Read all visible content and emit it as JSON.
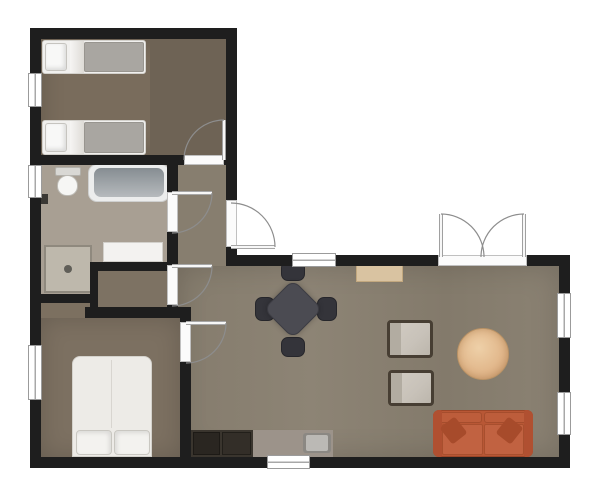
{
  "scene": {
    "width": 604,
    "height": 499,
    "background": "#ffffff",
    "palette": {
      "wall": "#1e1e1e",
      "wood_living": "#8a8172",
      "wood_bedroom": "#796c5c",
      "tile_bathroom": "#a89f93",
      "sofa_orange": "#b85735",
      "rug_tan": "#e2b88c",
      "table_dark": "#4b4b52",
      "counter_dark": "#3a352e",
      "counter_light": "#9c938a",
      "door_arc": "#8d8d8d"
    },
    "nodes": [
      {
        "name": "living-room-floor",
        "cls": "wood",
        "x": 178,
        "y": 266,
        "w": 381,
        "h": 191,
        "bg": "linear-gradient(90deg,#857c6d 0%,#8d8475 35%,#837a6b 70%,#8b8273 100%)",
        "sh": "inset 0 0 30px rgba(0,0,0,.16)"
      },
      {
        "name": "hallway-floor",
        "cls": "wood",
        "x": 178,
        "y": 165,
        "w": 48,
        "h": 101,
        "bg": "#877e6f"
      },
      {
        "name": "bedroom1-floor",
        "cls": "wood",
        "x": 41,
        "y": 39,
        "w": 185,
        "h": 116,
        "bg": "#796c5c",
        "sh": "inset 0 0 24px rgba(0,0,0,.18)"
      },
      {
        "name": "bedroom1-floor-right",
        "cls": "wood",
        "x": 150,
        "y": 39,
        "w": 76,
        "h": 116,
        "bg": "#6e6355"
      },
      {
        "name": "bathroom-floor",
        "cls": "tile",
        "x": 41,
        "y": 165,
        "w": 126,
        "h": 101,
        "bg": "#a89f93"
      },
      {
        "name": "bathroom-floor-notch",
        "cls": "tile",
        "x": 41,
        "y": 266,
        "w": 57,
        "h": 28,
        "bg": "#a89f93"
      },
      {
        "name": "closet-floor",
        "cls": "wood",
        "x": 98,
        "y": 271,
        "w": 69,
        "h": 36,
        "bg": "#7d7263"
      },
      {
        "name": "bedroom2-floor-strip",
        "cls": "wood",
        "x": 41,
        "y": 303,
        "w": 49,
        "h": 15,
        "bg": "#7c7060"
      },
      {
        "name": "bedroom2-floor",
        "cls": "wood",
        "x": 41,
        "y": 318,
        "w": 139,
        "h": 139,
        "bg": "#7c7061",
        "sh": "inset 0 0 24px rgba(0,0,0,.16)"
      },
      {
        "name": "single-bed-1-frame",
        "x": 42,
        "y": 40,
        "w": 104,
        "h": 34,
        "bg": "#f1f0ee",
        "bd": "1px solid #d3d1cc",
        "r": "3px"
      },
      {
        "name": "single-bed-1-fold",
        "x": 70,
        "y": 41,
        "w": 14,
        "h": 32,
        "bg": "linear-gradient(90deg,#f6f5f3,#dedbd6)"
      },
      {
        "name": "single-bed-1-duvet",
        "x": 84,
        "y": 42,
        "w": 60,
        "h": 30,
        "bg": "#a9a6a1",
        "bd": "1px solid #98958f",
        "r": "2px"
      },
      {
        "name": "single-bed-1-pillow",
        "x": 45,
        "y": 43,
        "w": 22,
        "h": 28,
        "bg": "#f8f8f7",
        "bd": "1px solid #c6c4bf",
        "r": "3px",
        "sh": "inset -2px -2px 4px rgba(0,0,0,.12)"
      },
      {
        "name": "single-bed-2-frame",
        "x": 42,
        "y": 120,
        "w": 104,
        "h": 35,
        "bg": "#f1f0ee",
        "bd": "1px solid #d3d1cc",
        "r": "3px"
      },
      {
        "name": "single-bed-2-fold",
        "x": 70,
        "y": 121,
        "w": 14,
        "h": 33,
        "bg": "linear-gradient(90deg,#f6f5f3,#dedbd6)"
      },
      {
        "name": "single-bed-2-duvet",
        "x": 84,
        "y": 122,
        "w": 60,
        "h": 31,
        "bg": "#a9a6a1",
        "bd": "1px solid #98958f",
        "r": "2px"
      },
      {
        "name": "single-bed-2-pillow",
        "x": 45,
        "y": 123,
        "w": 22,
        "h": 29,
        "bg": "#f8f8f7",
        "bd": "1px solid #c6c4bf",
        "r": "3px",
        "sh": "inset -2px -2px 4px rgba(0,0,0,.12)"
      },
      {
        "name": "toilet-tank",
        "x": 55,
        "y": 167,
        "w": 26,
        "h": 9,
        "bg": "#d9d8d4",
        "bd": "1px solid #b3b1ab",
        "r": "2px"
      },
      {
        "name": "toilet-bowl",
        "x": 57,
        "y": 175,
        "w": 21,
        "h": 21,
        "bg": "#f6f6f4",
        "bd": "1px solid #bdbbb5",
        "r": "50% 50% 46% 46%"
      },
      {
        "name": "bathtub",
        "x": 88,
        "y": 164,
        "w": 82,
        "h": 38,
        "bg": "#eceded",
        "bd": "1px solid #cfd0d0",
        "r": "9px"
      },
      {
        "name": "bathtub-basin",
        "x": 94,
        "y": 168,
        "w": 70,
        "h": 29,
        "bg": "linear-gradient(180deg,#868d92,#b6babd)",
        "r": "7px"
      },
      {
        "name": "towel-radiator",
        "x": 41,
        "y": 194,
        "w": 7,
        "h": 10,
        "bg": "#3a3834"
      },
      {
        "name": "shower",
        "x": 44,
        "y": 245,
        "w": 48,
        "h": 48,
        "bg": "#beb8ac",
        "bd": "2px solid #8f897e"
      },
      {
        "name": "shower-drain",
        "x": 64,
        "y": 265,
        "w": 8,
        "h": 8,
        "bg": "#605e58",
        "r": "50%"
      },
      {
        "name": "bathroom-vanity",
        "x": 103,
        "y": 242,
        "w": 60,
        "h": 20,
        "bg": "#f3f2f0",
        "bd": "1px solid #d2d0cb"
      },
      {
        "name": "double-bed-frame",
        "x": 72,
        "y": 356,
        "w": 80,
        "h": 101,
        "bg": "#edebe7",
        "bd": "1px solid #d4d2cc",
        "r": "8px 8px 0 0"
      },
      {
        "name": "double-bed-crease",
        "x": 111,
        "y": 360,
        "w": 1,
        "h": 68,
        "bg": "#d8d5d0"
      },
      {
        "name": "double-bed-pillow-left",
        "x": 76,
        "y": 430,
        "w": 36,
        "h": 25,
        "bg": "#f3f2ef",
        "bd": "1px solid #c9c7c1",
        "r": "4px",
        "sh": "inset -2px 2px 4px rgba(0,0,0,.10)"
      },
      {
        "name": "double-bed-pillow-right",
        "x": 114,
        "y": 430,
        "w": 36,
        "h": 25,
        "bg": "#f3f2ef",
        "bd": "1px solid #c9c7c1",
        "r": "4px",
        "sh": "inset 2px 2px 4px rgba(0,0,0,.10)"
      },
      {
        "name": "dining-chair-north",
        "x": 281,
        "y": 261,
        "w": 24,
        "h": 20,
        "bg": "#34343a",
        "bd": "1px solid #26262b",
        "r": "7px"
      },
      {
        "name": "dining-chair-south",
        "x": 281,
        "y": 337,
        "w": 24,
        "h": 20,
        "bg": "#34343a",
        "bd": "1px solid #26262b",
        "r": "7px"
      },
      {
        "name": "dining-chair-west",
        "x": 255,
        "y": 297,
        "w": 20,
        "h": 24,
        "bg": "#34343a",
        "bd": "1px solid #26262b",
        "r": "7px"
      },
      {
        "name": "dining-chair-east",
        "x": 317,
        "y": 297,
        "w": 20,
        "h": 24,
        "bg": "#34343a",
        "bd": "1px solid #26262b",
        "r": "7px"
      },
      {
        "name": "dining-table",
        "x": 272,
        "y": 288,
        "w": 42,
        "h": 42,
        "bg": "#4b4b52",
        "bd": "1px solid #3c3c43",
        "r": "9px",
        "rot": 45,
        "sh": "0 0 6px rgba(0,0,0,.25)"
      },
      {
        "name": "console-mat",
        "x": 356,
        "y": 262,
        "w": 47,
        "h": 20,
        "bg": "#d9c3a1",
        "bd": "1px solid #c2a87f"
      },
      {
        "name": "armchair-1",
        "x": 387,
        "y": 320,
        "w": 46,
        "h": 38,
        "bg": "linear-gradient(135deg,#d2ccc3 0%,#c8c2b9 60%,#bcb6ac 100%)",
        "bd": "3px solid #473e33",
        "r": "4px"
      },
      {
        "name": "armchair-1-throw",
        "x": 390,
        "y": 323,
        "w": 11,
        "h": 32,
        "bg": "#b2aca1"
      },
      {
        "name": "armchair-2",
        "x": 388,
        "y": 370,
        "w": 46,
        "h": 36,
        "bg": "linear-gradient(135deg,#d2ccc3 0%,#c8c2b9 60%,#bcb6ac 100%)",
        "bd": "3px solid #473e33",
        "r": "4px"
      },
      {
        "name": "armchair-2-throw",
        "x": 391,
        "y": 373,
        "w": 11,
        "h": 30,
        "bg": "#b2aca1"
      },
      {
        "name": "round-rug",
        "x": 457,
        "y": 328,
        "w": 52,
        "h": 52,
        "bg": "radial-gradient(circle at 42% 38%, #eed0a8 0%, #e2b88c 55%, #d3a478 85%, #c69868 100%)",
        "bd": "1px solid #b99265",
        "r": "50%",
        "sh": "inset 0 0 8px rgba(140,95,45,.35)"
      },
      {
        "name": "sofa",
        "x": 433,
        "y": 410,
        "w": 100,
        "h": 47,
        "bg": "#b85735",
        "bd": "1px solid #9a4628",
        "r": "6px"
      },
      {
        "name": "sofa-back-left",
        "x": 437,
        "y": 412,
        "w": 45,
        "h": 11,
        "bg": "#bd5d3b",
        "bd": "1px solid #a54d2d",
        "r": "3px"
      },
      {
        "name": "sofa-back-right",
        "x": 484,
        "y": 412,
        "w": 45,
        "h": 11,
        "bg": "#bd5d3b",
        "bd": "1px solid #a54d2d",
        "r": "3px"
      },
      {
        "name": "sofa-armrest-left",
        "x": 433,
        "y": 410,
        "w": 9,
        "h": 47,
        "bg": "#b05031",
        "r": "6px 2px 2px 6px"
      },
      {
        "name": "sofa-armrest-right",
        "x": 524,
        "y": 410,
        "w": 9,
        "h": 47,
        "bg": "#b05031",
        "r": "2px 6px 6px 2px"
      },
      {
        "name": "sofa-seat-left",
        "x": 442,
        "y": 424,
        "w": 41,
        "h": 31,
        "bg": "#c16241",
        "bd": "1px solid #a84f2e",
        "r": "2px"
      },
      {
        "name": "sofa-seat-right",
        "x": 484,
        "y": 424,
        "w": 40,
        "h": 31,
        "bg": "#c16241",
        "bd": "1px solid #a84f2e",
        "r": "2px"
      },
      {
        "name": "sofa-pillow-left",
        "x": 444,
        "y": 420,
        "w": 19,
        "h": 21,
        "bg": "#a74b2b",
        "r": "3px",
        "rot": -38
      },
      {
        "name": "sofa-pillow-right",
        "x": 500,
        "y": 420,
        "w": 19,
        "h": 21,
        "bg": "#a74b2b",
        "r": "3px",
        "rot": 38
      },
      {
        "name": "kitchen-counter-dark",
        "x": 191,
        "y": 430,
        "w": 62,
        "h": 27,
        "bg": "#3a352e"
      },
      {
        "name": "kitchen-cooktop",
        "x": 193,
        "y": 432,
        "w": 27,
        "h": 23,
        "bg": "#2a2621",
        "bd": "1px solid #1d1a16"
      },
      {
        "name": "kitchen-oven",
        "x": 222,
        "y": 432,
        "w": 29,
        "h": 23,
        "bg": "#332e28",
        "bd": "1px solid #221f1a"
      },
      {
        "name": "kitchen-counter-light",
        "x": 253,
        "y": 430,
        "w": 80,
        "h": 27,
        "bg": "#9c938a"
      },
      {
        "name": "kitchen-sink",
        "x": 303,
        "y": 433,
        "w": 28,
        "h": 20,
        "bg": "#8b8883",
        "r": "3px"
      },
      {
        "name": "kitchen-sink-basin",
        "x": 306,
        "y": 435,
        "w": 22,
        "h": 16,
        "bg": "#bbb9b5",
        "r": "2px"
      },
      {
        "name": "wall-top",
        "cls": "wall",
        "x": 30,
        "y": 28,
        "w": 207,
        "h": 11
      },
      {
        "name": "wall-left-1",
        "cls": "wall",
        "x": 30,
        "y": 39,
        "w": 11,
        "h": 34
      },
      {
        "name": "wall-left-2",
        "cls": "wall",
        "x": 30,
        "y": 107,
        "w": 11,
        "h": 58
      },
      {
        "name": "wall-left-3",
        "cls": "wall",
        "x": 30,
        "y": 198,
        "w": 11,
        "h": 147
      },
      {
        "name": "wall-left-4",
        "cls": "wall",
        "x": 30,
        "y": 400,
        "w": 11,
        "h": 57
      },
      {
        "name": "wall-entry-east-1",
        "cls": "wall",
        "x": 226,
        "y": 39,
        "w": 11,
        "h": 161
      },
      {
        "name": "wall-entry-east-2",
        "cls": "wall",
        "x": 226,
        "y": 247,
        "w": 11,
        "h": 19
      },
      {
        "name": "wall-bedroom1-bottom-1",
        "cls": "wall",
        "x": 30,
        "y": 155,
        "w": 154,
        "h": 10
      },
      {
        "name": "wall-bedroom1-bottom-2",
        "cls": "wall",
        "x": 224,
        "y": 155,
        "w": 13,
        "h": 10
      },
      {
        "name": "wall-bathroom-east-1",
        "cls": "wall",
        "x": 167,
        "y": 165,
        "w": 11,
        "h": 27
      },
      {
        "name": "wall-bathroom-east-2",
        "cls": "wall",
        "x": 167,
        "y": 232,
        "w": 11,
        "h": 33
      },
      {
        "name": "wall-bathroom-east-3",
        "cls": "wall",
        "x": 167,
        "y": 305,
        "w": 11,
        "h": 13
      },
      {
        "name": "wall-closet-top",
        "cls": "wall",
        "x": 90,
        "y": 262,
        "w": 88,
        "h": 9
      },
      {
        "name": "wall-closet-left",
        "cls": "wall",
        "x": 90,
        "y": 262,
        "w": 8,
        "h": 56
      },
      {
        "name": "wall-bathroom-bottom",
        "cls": "wall",
        "x": 30,
        "y": 294,
        "w": 68,
        "h": 9
      },
      {
        "name": "wall-bedroom2-top",
        "cls": "wall",
        "x": 85,
        "y": 307,
        "w": 106,
        "h": 11
      },
      {
        "name": "wall-bedroom2-east-1",
        "cls": "wall",
        "x": 180,
        "y": 307,
        "w": 11,
        "h": 15
      },
      {
        "name": "wall-bedroom2-east-2",
        "cls": "wall",
        "x": 180,
        "y": 362,
        "w": 11,
        "h": 95
      },
      {
        "name": "wall-living-top-1",
        "cls": "wall",
        "x": 237,
        "y": 255,
        "w": 55,
        "h": 11
      },
      {
        "name": "wall-living-top-2",
        "cls": "wall",
        "x": 336,
        "y": 255,
        "w": 102,
        "h": 11
      },
      {
        "name": "wall-living-top-3",
        "cls": "wall",
        "x": 527,
        "y": 255,
        "w": 43,
        "h": 11
      },
      {
        "name": "wall-right-1",
        "cls": "wall",
        "x": 559,
        "y": 255,
        "w": 11,
        "h": 38
      },
      {
        "name": "wall-right-2",
        "cls": "wall",
        "x": 559,
        "y": 338,
        "w": 11,
        "h": 54
      },
      {
        "name": "wall-right-3",
        "cls": "wall",
        "x": 559,
        "y": 435,
        "w": 11,
        "h": 33
      },
      {
        "name": "wall-bottom-1",
        "cls": "wall",
        "x": 30,
        "y": 457,
        "w": 237,
        "h": 11
      },
      {
        "name": "wall-bottom-2",
        "cls": "wall",
        "x": 310,
        "y": 457,
        "w": 260,
        "h": 11
      },
      {
        "name": "window-bedroom1-left",
        "cls": "window win-v",
        "x": 28,
        "y": 73,
        "w": 14,
        "h": 34
      },
      {
        "name": "window-bathroom-left",
        "cls": "window win-v",
        "x": 28,
        "y": 165,
        "w": 14,
        "h": 33
      },
      {
        "name": "window-bedroom2-left",
        "cls": "window win-v",
        "x": 28,
        "y": 345,
        "w": 14,
        "h": 55
      },
      {
        "name": "window-living-top",
        "cls": "window win-h",
        "x": 292,
        "y": 253,
        "w": 44,
        "h": 14
      },
      {
        "name": "window-kitchen-bottom",
        "cls": "window win-h",
        "x": 267,
        "y": 455,
        "w": 43,
        "h": 14
      },
      {
        "name": "window-living-right-1",
        "cls": "window win-v",
        "x": 557,
        "y": 293,
        "w": 14,
        "h": 45
      },
      {
        "name": "window-living-right-2",
        "cls": "window win-v",
        "x": 557,
        "y": 392,
        "w": 14,
        "h": 43
      },
      {
        "name": "threshold-bedroom1-door",
        "cls": "threshold",
        "x": 184,
        "y": 155,
        "w": 40,
        "h": 10
      },
      {
        "name": "threshold-entrance-door",
        "cls": "threshold",
        "x": 226,
        "y": 200,
        "w": 11,
        "h": 47
      },
      {
        "name": "threshold-bathroom-door",
        "cls": "threshold",
        "x": 167,
        "y": 192,
        "w": 11,
        "h": 40
      },
      {
        "name": "threshold-closet-door",
        "cls": "threshold",
        "x": 167,
        "y": 265,
        "w": 11,
        "h": 40
      },
      {
        "name": "threshold-bedroom2-door",
        "cls": "threshold",
        "x": 180,
        "y": 322,
        "w": 11,
        "h": 40
      },
      {
        "name": "threshold-french-doors",
        "cls": "threshold win-h",
        "x": 438,
        "y": 255,
        "w": 89,
        "h": 11
      }
    ],
    "door_style": {
      "arc_stroke": "#8d8d8d",
      "arc_width": 1.2,
      "leaf_casing": "#8a8a8a",
      "leaf_casing_width": 4,
      "leaf_fill": "#f7f7f7",
      "leaf_fill_width": 2.4
    },
    "doors": [
      {
        "name": "bedroom1-door",
        "leaf": "M224,160 L224,120",
        "arc": "M184,160 A40,40 0 0 1 224,120"
      },
      {
        "name": "entrance-door",
        "leaf": "M231,247 L275,247",
        "arc": "M275,247 A44,44 0 0 0 231,203"
      },
      {
        "name": "bathroom-door",
        "leaf": "M172,193 L212,193",
        "arc": "M212,193 A40,40 0 0 1 172,233"
      },
      {
        "name": "closet-door",
        "leaf": "M172,266 L212,266",
        "arc": "M212,266 A40,40 0 0 1 172,306"
      },
      {
        "name": "bedroom2-door",
        "leaf": "M186,323 L226,323",
        "arc": "M226,323 A40,40 0 0 1 186,363"
      },
      {
        "name": "french-door-left",
        "leaf": "M441,257 L441,214",
        "arc": "M441,214 A43,43 0 0 1 484,257"
      },
      {
        "name": "french-door-right",
        "leaf": "M524,257 L524,214",
        "arc": "M524,214 A43,43 0 0 0 481,257"
      }
    ]
  }
}
